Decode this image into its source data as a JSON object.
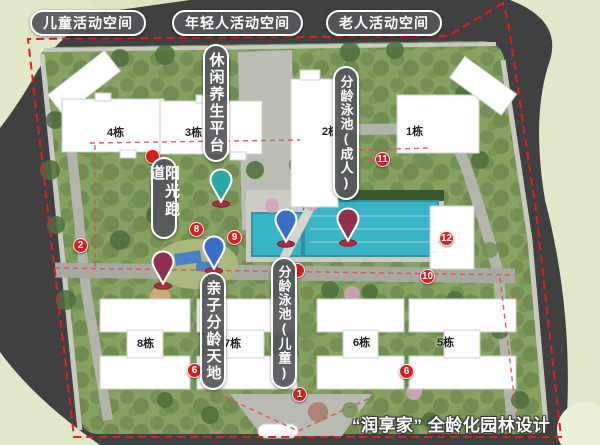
{
  "title": "“润享家” 全龄化园林设计",
  "zones": [
    {
      "label": "儿童活动空间"
    },
    {
      "label": "年轻人活动空间"
    },
    {
      "label": "老人活动空间"
    }
  ],
  "features": [
    {
      "label": "休闲养生平台"
    },
    {
      "label": "分龄泳池(成人)"
    },
    {
      "label": "阳光跑道"
    },
    {
      "label": "亲子分龄天地"
    },
    {
      "label": "分龄泳池(儿童)"
    }
  ],
  "buildings": [
    {
      "label": "4栋"
    },
    {
      "label": "3栋"
    },
    {
      "label": "2栋"
    },
    {
      "label": "1栋"
    },
    {
      "label": "8栋"
    },
    {
      "label": "7栋"
    },
    {
      "label": "6栋"
    },
    {
      "label": "5栋"
    }
  ],
  "markers": [
    {
      "label": "1"
    },
    {
      "label": "2"
    },
    {
      "label": "6"
    },
    {
      "label": "6"
    },
    {
      "label": "8"
    },
    {
      "label": "9"
    },
    {
      "label": "10"
    },
    {
      "label": "11"
    },
    {
      "label": "12"
    }
  ],
  "pins": [
    {
      "name": "leisure-wellness-pin",
      "color": "#2aa79e"
    },
    {
      "name": "parent-child-zone-pin",
      "color": "#3d6ec3"
    },
    {
      "name": "sun-track-pin",
      "color": "#8e3050"
    },
    {
      "name": "kids-pool-pin",
      "color": "#3d6ec3"
    },
    {
      "name": "adult-pool-pin",
      "color": "#8e3050"
    }
  ],
  "colors": {
    "marker_red": "#d32020",
    "boundary_red": "#e01f1f",
    "pool_teal": "#3ab3c5",
    "road_gray": "#404042",
    "outside_beige": "#e3e7c9",
    "site_green": "#86a161",
    "label_bg": "#55565a"
  }
}
